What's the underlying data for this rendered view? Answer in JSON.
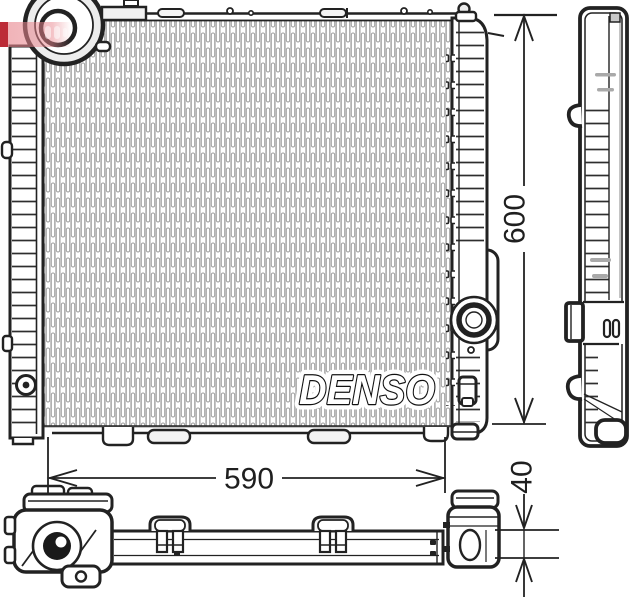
{
  "brand_logo": "DENSO",
  "dimensions": {
    "height": "600",
    "width": "590",
    "depth": "40"
  },
  "colors": {
    "line": "#1f1f1f",
    "fin_slot": "#9f9f9f",
    "fin_grid": "#cfcfcf",
    "background": "#ffffff",
    "watermark_red": "#b30f1c",
    "watermark_pink": "#e8858d"
  }
}
